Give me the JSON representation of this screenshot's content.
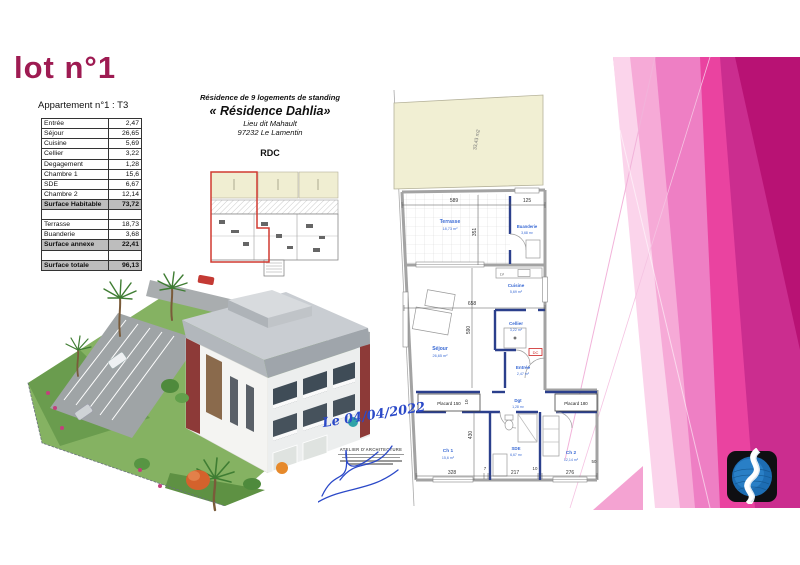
{
  "page": {
    "lot_title": "lot n°1",
    "apartment_subtitle": "Appartement n°1 : T3"
  },
  "surface_table": {
    "rows": [
      {
        "label": "Entrée",
        "value": "2,47",
        "type": "normal"
      },
      {
        "label": "Séjour",
        "value": "26,65",
        "type": "normal"
      },
      {
        "label": "Cuisine",
        "value": "5,69",
        "type": "normal"
      },
      {
        "label": "Cellier",
        "value": "3,22",
        "type": "normal"
      },
      {
        "label": "Degagement",
        "value": "1,28",
        "type": "normal"
      },
      {
        "label": "Chambre 1",
        "value": "15,6",
        "type": "normal"
      },
      {
        "label": "SDE",
        "value": "6,67",
        "type": "normal"
      },
      {
        "label": "Chambre 2",
        "value": "12,14",
        "type": "normal"
      },
      {
        "label": "Surface Habitable",
        "value": "73,72",
        "type": "summary"
      },
      {
        "label": "",
        "value": "",
        "type": "spacer"
      },
      {
        "label": "Terrasse",
        "value": "18,73",
        "type": "normal"
      },
      {
        "label": "Buanderie",
        "value": "3,68",
        "type": "normal"
      },
      {
        "label": "Surface annexe",
        "value": "22,41",
        "type": "summary"
      },
      {
        "label": "",
        "value": "",
        "type": "spacer"
      },
      {
        "label": "Surface totale",
        "value": "96,13",
        "type": "summary"
      }
    ]
  },
  "project": {
    "line1": "Résidence de 9 logements de standing",
    "name": "« Résidence Dahlia»",
    "line3": "Lieu dit Mahault",
    "line4": "97232 Le Lamentin",
    "floor": "RDC"
  },
  "floorplan": {
    "garden_area": "33,43 m2",
    "rooms": {
      "terrasse": {
        "name": "Terrasse",
        "area": "18,73 m²"
      },
      "buanderie": {
        "name": "Buanderie",
        "area": "3,68 m²"
      },
      "cuisine": {
        "name": "Cuisine",
        "area": "5,69 m²"
      },
      "cellier": {
        "name": "Cellier",
        "area": "3,22 m²"
      },
      "entree": {
        "name": "Entrée",
        "area": "2,47 m²"
      },
      "sejour": {
        "name": "Séjour",
        "area": "26,65 m²"
      },
      "dgt": {
        "name": "Dgt",
        "area": "1,28 m²"
      },
      "ch1": {
        "name": "Ch 1",
        "area": "15,6 m²"
      },
      "sde": {
        "name": "SDE",
        "area": "6,67 m²"
      },
      "ch2": {
        "name": "Ch 2",
        "area": "12,14 m²"
      }
    },
    "placard_left": "Placard 150",
    "placard_right": "Placard 180",
    "labels": {
      "lv": "LV",
      "dc": "DC"
    },
    "dims": {
      "w589": "589",
      "w125": "125",
      "h351": "351",
      "w658": "658",
      "h590": "590",
      "h10": "10",
      "h430": "430",
      "b328": "328",
      "b7": "7",
      "b217": "217",
      "b10": "10",
      "b276": "276",
      "b50": "50"
    }
  },
  "annotations": {
    "date": "Le 04/04/2022",
    "stamp_line1": "ATELIER D'ARCHITECTURE"
  },
  "colors": {
    "accent_magenta": "#9e1b52",
    "pink_dark": "#b81274",
    "pink_mid": "#ee7fc4",
    "pink_vivid": "#ea43a0",
    "plan_blue": "#2b3f8c",
    "label_blue": "#3a6ad4",
    "garden_cream": "#f1efd3",
    "logo_blue": "#1d6db3"
  }
}
